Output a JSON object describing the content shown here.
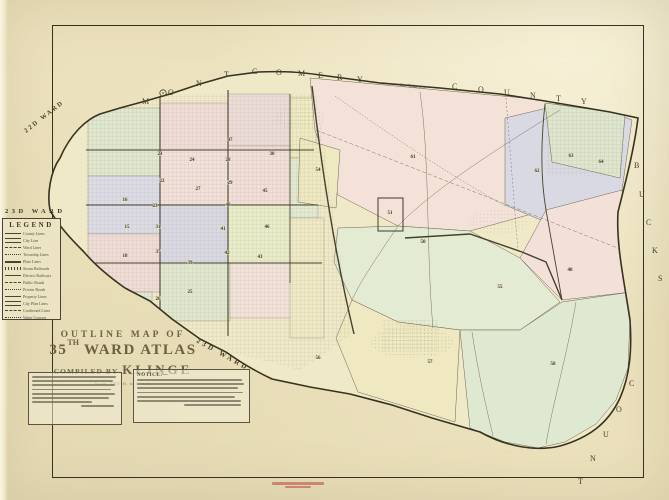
{
  "page": {
    "paper_color": "#ebe1bc",
    "ink_color": "#46412f"
  },
  "title_block": {
    "line1": "OUTLINE MAP OF",
    "line2_num": "35",
    "line2_sup": "TH",
    "line2_rest": "WARD ATLAS",
    "compiled_by": "COMPILED BY",
    "compiler": "KLINGE",
    "scale": "Scale, 2000 ft. to 1 inch."
  },
  "legend": {
    "title": "LEGEND",
    "items": [
      "County Lines",
      "City Line",
      "Ward Lines",
      "Township Lines",
      "Plate Lines",
      "Steam Railroads",
      "Electric Railways",
      "Public Roads",
      "Private Roads",
      "Property Lines",
      "City Plan Lines",
      "Confirmed Lines",
      "Water Courses"
    ]
  },
  "labels": {
    "montgomery": "MONTGOMERY",
    "county_top": "COUNTY",
    "bucks": "BUCKS",
    "county_right": "COUNTY",
    "ward_nw": "22D WARD",
    "ward_w": "23D WARD",
    "ward_sw": "23D WARD",
    "see_volume": "See Volume 2"
  },
  "notice": {
    "title": "NOTICE:—"
  },
  "plates": [
    {
      "n": "16",
      "x": 125,
      "y": 201
    },
    {
      "n": "15",
      "x": 127,
      "y": 228
    },
    {
      "n": "18",
      "x": 125,
      "y": 257
    },
    {
      "n": "21",
      "x": 160,
      "y": 155
    },
    {
      "n": "22",
      "x": 162,
      "y": 182
    },
    {
      "n": "23",
      "x": 155,
      "y": 207
    },
    {
      "n": "31",
      "x": 158,
      "y": 228
    },
    {
      "n": "37",
      "x": 158,
      "y": 253
    },
    {
      "n": "26",
      "x": 158,
      "y": 300
    },
    {
      "n": "24",
      "x": 192,
      "y": 161
    },
    {
      "n": "27",
      "x": 198,
      "y": 190
    },
    {
      "n": "39",
      "x": 190,
      "y": 264
    },
    {
      "n": "25",
      "x": 190,
      "y": 293
    },
    {
      "n": "47",
      "x": 230,
      "y": 141
    },
    {
      "n": "28",
      "x": 228,
      "y": 161
    },
    {
      "n": "29",
      "x": 230,
      "y": 184
    },
    {
      "n": "40",
      "x": 228,
      "y": 206
    },
    {
      "n": "41",
      "x": 223,
      "y": 230
    },
    {
      "n": "42",
      "x": 227,
      "y": 254
    },
    {
      "n": "30",
      "x": 272,
      "y": 155
    },
    {
      "n": "45",
      "x": 265,
      "y": 192
    },
    {
      "n": "46",
      "x": 267,
      "y": 228
    },
    {
      "n": "43",
      "x": 260,
      "y": 258
    },
    {
      "n": "54",
      "x": 318,
      "y": 171
    },
    {
      "n": "61",
      "x": 413,
      "y": 158
    },
    {
      "n": "51",
      "x": 390,
      "y": 214
    },
    {
      "n": "50",
      "x": 423,
      "y": 243
    },
    {
      "n": "62",
      "x": 537,
      "y": 172
    },
    {
      "n": "63",
      "x": 571,
      "y": 157
    },
    {
      "n": "64",
      "x": 601,
      "y": 163
    },
    {
      "n": "48",
      "x": 570,
      "y": 271
    },
    {
      "n": "55",
      "x": 500,
      "y": 288
    },
    {
      "n": "56",
      "x": 318,
      "y": 359
    },
    {
      "n": "57",
      "x": 430,
      "y": 363
    },
    {
      "n": "58",
      "x": 553,
      "y": 365
    }
  ],
  "stamp": {
    "color": "#c05a50"
  }
}
